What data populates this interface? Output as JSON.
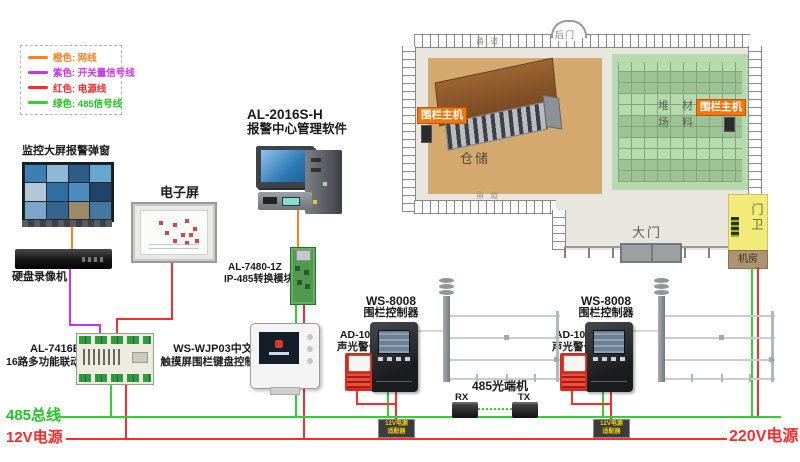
{
  "legend": {
    "items": [
      {
        "label": "橙色: 网线",
        "color": "#ff7f1f"
      },
      {
        "label": "紫色: 开关量信号线",
        "color": "#cf2fef"
      },
      {
        "label": "红色: 电源线",
        "color": "#ff2a2a"
      },
      {
        "label": "绿色: 485信号线",
        "color": "#22c522"
      }
    ]
  },
  "devices": {
    "monitor_wall": {
      "label": "监控大屏报警弹窗",
      "cell_colors": [
        "#3a7fb5",
        "#8fb8d8",
        "#2c5d8a",
        "#67a7cf",
        "#b0c8d8",
        "#2f6fa3",
        "#4d8cbf",
        "#1f4468",
        "#7aa6c9",
        "#35648f",
        "#9c8b6a",
        "#44799f"
      ]
    },
    "dvr": {
      "label": "硬盘录像机"
    },
    "eboard": {
      "label": "电子屏"
    },
    "software": {
      "line1": "AL-2016S-H",
      "line2": "报警中心管理软件"
    },
    "converter": {
      "line1": "AL-7480-1Z",
      "line2": "IP-485转换模块"
    },
    "linkage": {
      "line1": "AL-7416E",
      "line2": "16路多功能联动模块"
    },
    "keypad": {
      "line1": "WS-WJP03中文",
      "line2": "触摸屏围栏键盘控制器"
    },
    "controller": {
      "line1": "WS-8008",
      "line2": "围栏控制器"
    },
    "siren": {
      "line1": "AD-103",
      "line2": "声光警号"
    },
    "optical": {
      "label": "485光端机",
      "rx": "RX",
      "tx": "TX"
    },
    "adapter": {
      "line1": "12V电源",
      "line2": "适配器"
    }
  },
  "buses": {
    "bus485": "485总线",
    "power12": "12V电源",
    "power220": "220V电源",
    "bus485_color": "#2ed32e",
    "power_color": "#ff2a2a"
  },
  "map": {
    "road": "甬 道",
    "back_gate": "后门",
    "warehouse": "仓储",
    "yard_line1": "堆 材",
    "yard_line2": "场 料",
    "fence_host": "围栏主机",
    "main_gate": "大门",
    "guard": "门卫",
    "machine_room": "机房",
    "badge_color": "#f2750e"
  }
}
